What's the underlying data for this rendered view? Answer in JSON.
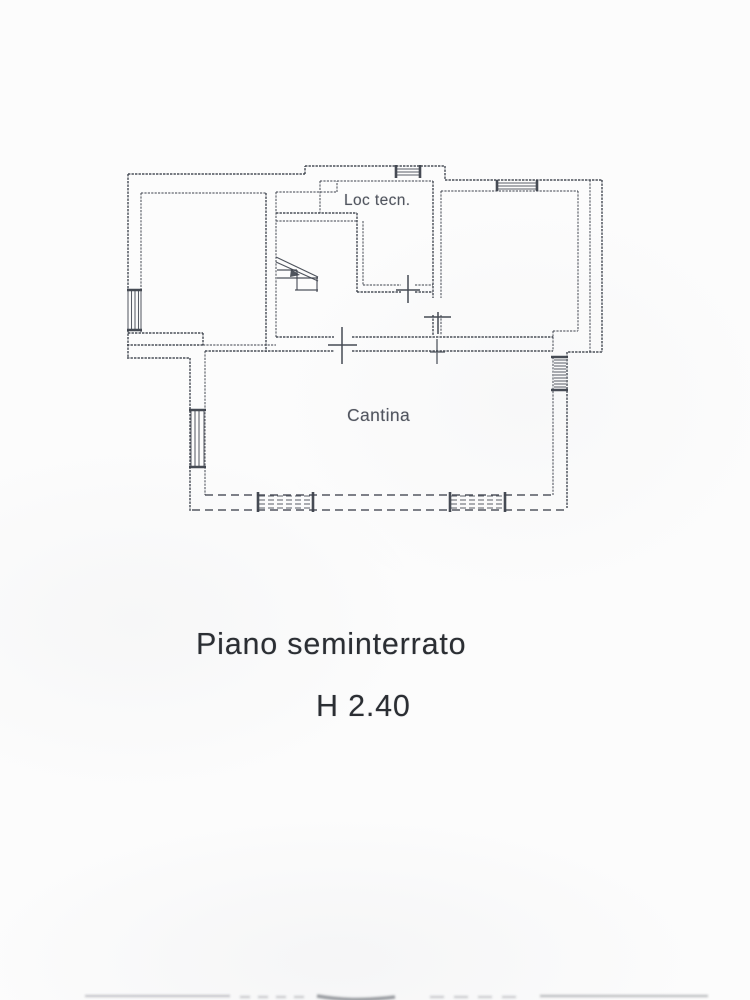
{
  "page": {
    "colors": {
      "background": "#fcfcfc",
      "line": "#3c414b",
      "labeltext": "#484d57",
      "captiontext": "#2b2e33"
    }
  },
  "plan": {
    "room_labels": {
      "loc_tecn": "Loc tecn.",
      "cantina": "Cantina"
    },
    "caption": {
      "floor": "Piano seminterrato",
      "height": "H 2.40"
    }
  }
}
